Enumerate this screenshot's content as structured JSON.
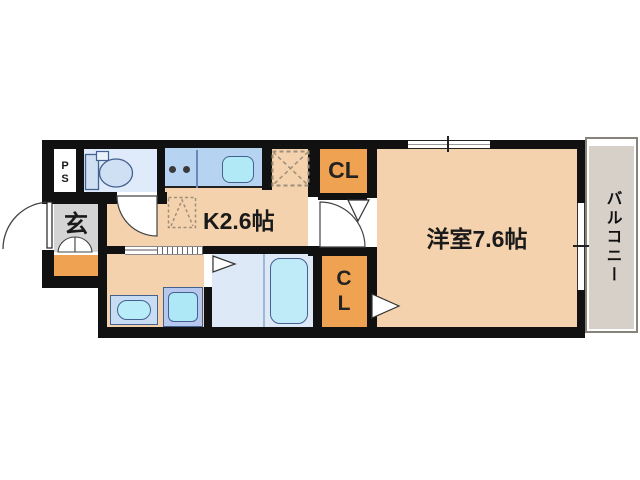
{
  "floorplan": {
    "labels": {
      "pipe_space": "PS",
      "entrance": "玄",
      "kitchen": "K2.6帖",
      "closet_upper": "CL",
      "closet_lower": "CL",
      "western_room": "洋室7.6帖",
      "balcony": "バルコニー"
    },
    "rooms": [
      {
        "name": "kitchen",
        "label": "K2.6帖"
      },
      {
        "name": "western_room",
        "label": "洋室7.6帖"
      },
      {
        "name": "balcony",
        "label": "バルコニー"
      },
      {
        "name": "entrance",
        "label": "玄"
      },
      {
        "name": "closet_upper",
        "label": "CL"
      },
      {
        "name": "closet_lower",
        "label": "CL"
      },
      {
        "name": "pipe_space",
        "label": "PS"
      }
    ],
    "colors": {
      "wall": "#111111",
      "floor_tan": "#f4d2ad",
      "closet_orange": "#efa251",
      "entrance_gray": "#d4d4d4",
      "wet_area_blue": "#dde9f6",
      "counter_blue": "#b7d3f2",
      "fixture_cyan": "#b2e9f7",
      "balcony_gray": "#d7d0c8"
    }
  }
}
